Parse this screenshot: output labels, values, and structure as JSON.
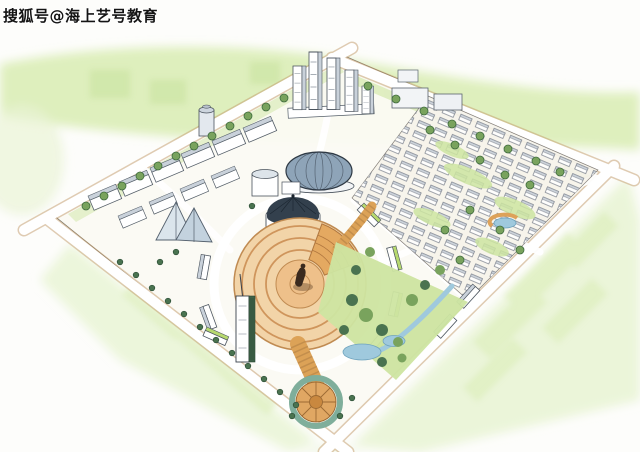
{
  "watermark": {
    "text": "搜狐号@海上艺号教育"
  },
  "palette": {
    "paper": "#fdfdfb",
    "wash_green": "#d8ecb2",
    "wash_green_light": "#e9f4d5",
    "wash_deep": "#c5e09a",
    "lawn_green": "#cde5a1",
    "roof_green": "#b7d96f",
    "foliage_green": "#79a35d",
    "foliage_dark": "#4a7350",
    "plaza_fill": "#f2d4a8",
    "plaza_deep": "#e0a763",
    "plaza_ring": "#cf955c",
    "boardwalk": "#dca257",
    "road_edge_tan": "#c2996a",
    "water_blue": "#9fc9dd",
    "dome_gray": "#8ea4b8",
    "bldg_side": "#c9d1da",
    "ink_navy": "#414a54",
    "watermark_black": "#141414"
  }
}
